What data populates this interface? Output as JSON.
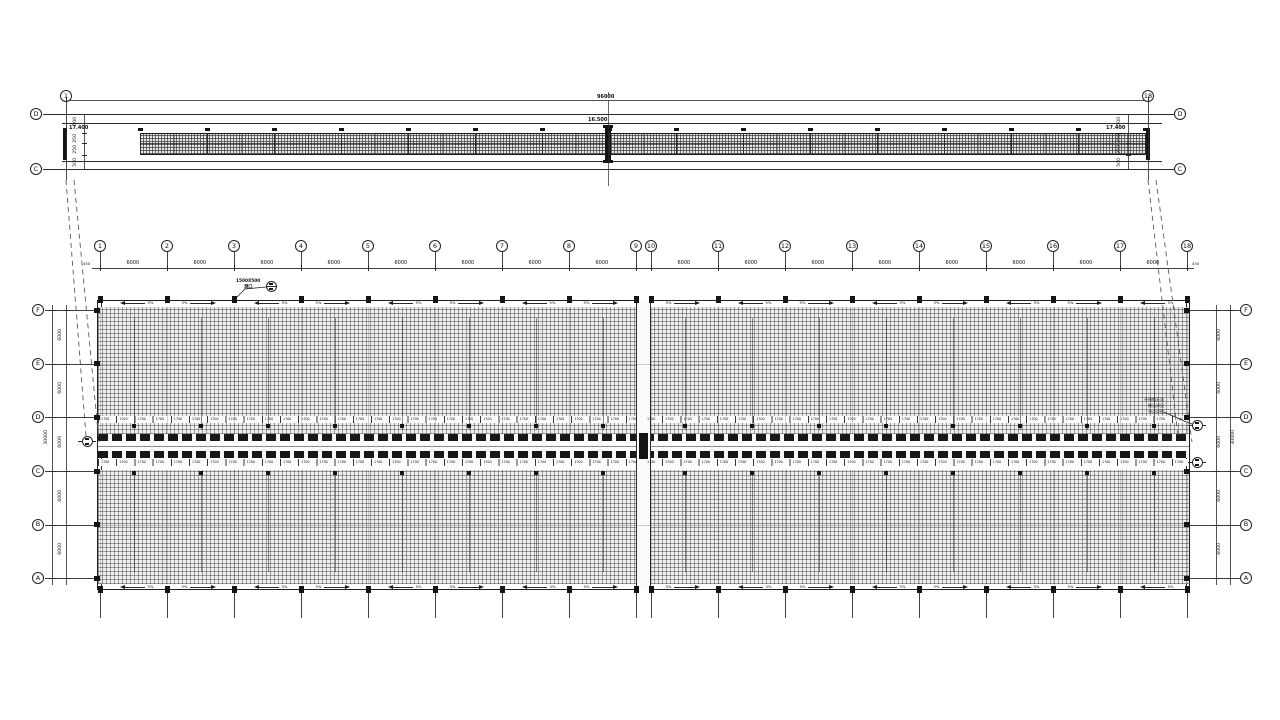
{
  "sheet": {
    "kind": "structural roof framing plan (CAD drawing)",
    "colors": {
      "ink": "#2b2b2b",
      "text": "#101010",
      "hatch_bg": "#efefef",
      "paper": "#ffffff"
    },
    "strip": {
      "start_bubble": "1",
      "end_bubble": "18",
      "left_row_bubbles": [
        "D",
        "C"
      ],
      "right_row_bubbles": [
        "D",
        "C"
      ],
      "overall_dim": "96000",
      "center_dim": "16.500",
      "left_elev": "17.400",
      "right_elev": "17.400",
      "side_dims": [
        "500",
        "250",
        "250",
        "500"
      ]
    },
    "plan": {
      "grid_labels": [
        "1",
        "2",
        "3",
        "4",
        "5",
        "6",
        "7",
        "8",
        "9",
        "10",
        "11",
        "12",
        "13",
        "14",
        "15",
        "16",
        "17",
        "18"
      ],
      "row_labels": [
        "F",
        "E",
        "D",
        "C",
        "B",
        "A"
      ],
      "bay_dim": "6000",
      "row_dim": "6000",
      "row_overall": "30000",
      "end_offset_dim": "450",
      "slope_label": "5%",
      "purlin_dim": "1700",
      "callout_line1": "1500X500",
      "callout_line2": "洞口",
      "gutter_note_lines": [
        "不锈钢天沟",
        "做法详见",
        "节点详图"
      ]
    }
  }
}
